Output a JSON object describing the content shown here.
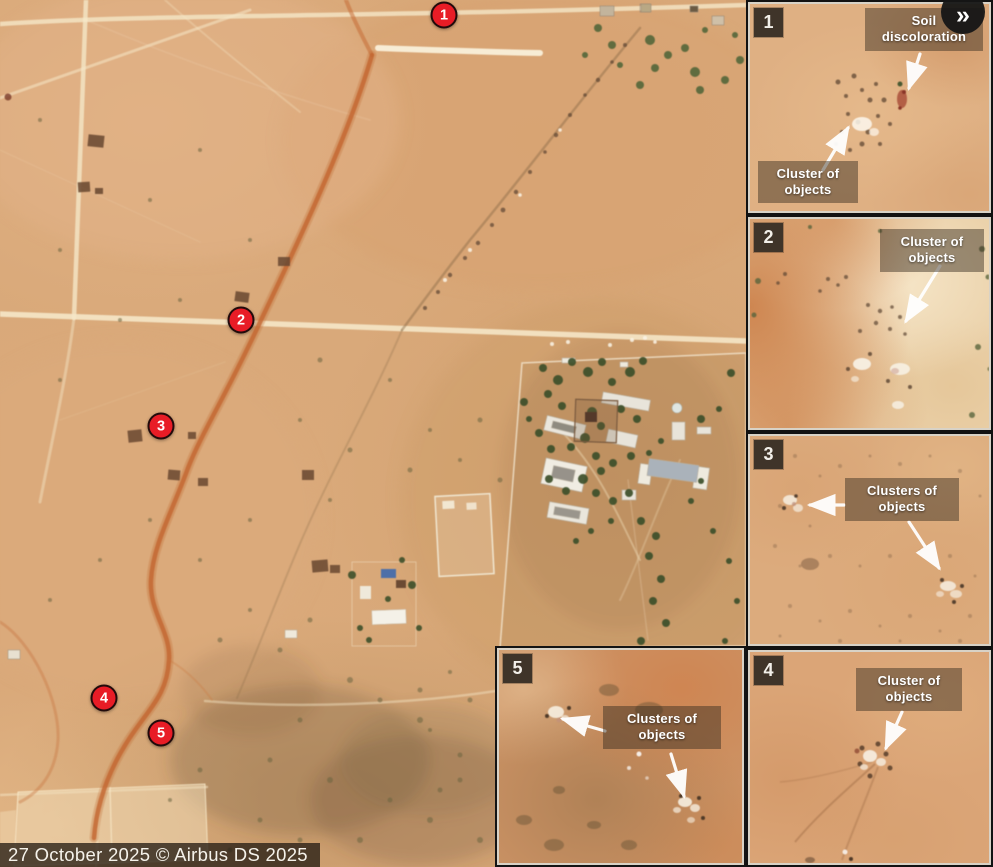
{
  "attribution": {
    "text": "27 October 2025 © Airbus DS 2025"
  },
  "controls": {
    "expand_glyph": "»",
    "expand_icon": "chevron-double-right"
  },
  "map": {
    "marker_color": "#e81c26",
    "markers": [
      {
        "id": "1",
        "x": 444,
        "y": 15
      },
      {
        "id": "2",
        "x": 241,
        "y": 320
      },
      {
        "id": "3",
        "x": 161,
        "y": 426
      },
      {
        "id": "4",
        "x": 104,
        "y": 698
      },
      {
        "id": "5",
        "x": 161,
        "y": 733
      }
    ]
  },
  "insets": [
    {
      "id": "1",
      "labels": [
        {
          "text": "Soil discoloration",
          "pos": {
            "top": "4px",
            "right": "6px",
            "width": "118px"
          }
        },
        {
          "text": "Cluster of objects",
          "pos": {
            "bottom": "8px",
            "left": "8px",
            "width": "100px"
          }
        }
      ],
      "arrows": [
        {
          "x1": 170,
          "y1": 50,
          "x2": 159,
          "y2": 84
        },
        {
          "x1": 73,
          "y1": 166,
          "x2": 98,
          "y2": 124
        }
      ]
    },
    {
      "id": "2",
      "labels": [
        {
          "text": "Cluster of objects",
          "pos": {
            "top": "10px",
            "right": "5px",
            "width": "104px"
          }
        }
      ],
      "arrows": [
        {
          "x1": 190,
          "y1": 47,
          "x2": 156,
          "y2": 102
        }
      ]
    },
    {
      "id": "3",
      "labels": [
        {
          "text": "Clusters of objects",
          "pos": {
            "top": "42px",
            "left": "95px",
            "width": "114px"
          }
        }
      ],
      "arrows": [
        {
          "x1": 94,
          "y1": 69,
          "x2": 60,
          "y2": 69
        },
        {
          "x1": 159,
          "y1": 86,
          "x2": 189,
          "y2": 132
        }
      ]
    },
    {
      "id": "4",
      "labels": [
        {
          "text": "Cluster of objects",
          "pos": {
            "top": "16px",
            "left": "106px",
            "width": "106px"
          }
        }
      ],
      "arrows": [
        {
          "x1": 152,
          "y1": 60,
          "x2": 136,
          "y2": 96
        }
      ]
    },
    {
      "id": "5",
      "labels": [
        {
          "text": "Clusters of objects",
          "pos": {
            "top": "56px",
            "left": "104px",
            "width": "118px"
          }
        }
      ],
      "arrows": [
        {
          "x1": 106,
          "y1": 81,
          "x2": 64,
          "y2": 69
        },
        {
          "x1": 172,
          "y1": 104,
          "x2": 185,
          "y2": 146
        }
      ]
    }
  ]
}
